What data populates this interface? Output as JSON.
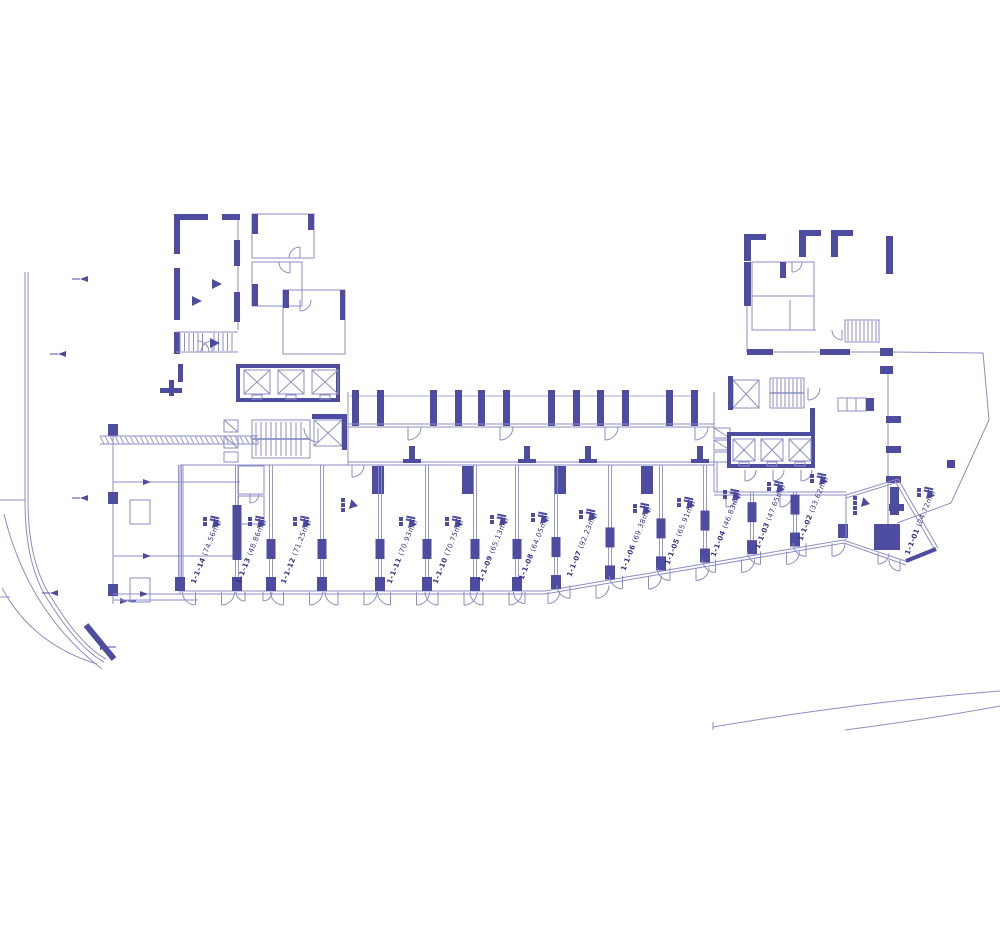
{
  "drawing": {
    "kind": "architectural-floor-plan",
    "palette": {
      "wall": "#4d4ca0",
      "line": "#8c8ec5",
      "text": "#33338c",
      "background": "#ffffff"
    }
  },
  "units": [
    {
      "id": "1-1-14",
      "area_label": "(74.56m²)"
    },
    {
      "id": "1-1-13",
      "area_label": "(48.86m²)"
    },
    {
      "id": "1-1-12",
      "area_label": "(71.25m²)"
    },
    {
      "id": "1-1-11",
      "area_label": "(70.93m²)"
    },
    {
      "id": "1-1-10",
      "area_label": "(70.75m²)"
    },
    {
      "id": "1-1-09",
      "area_label": "(65.13m²)"
    },
    {
      "id": "1-1-08",
      "area_label": "(64.05m²)"
    },
    {
      "id": "1-1-07",
      "area_label": "(92.23m²)"
    },
    {
      "id": "1-1-06",
      "area_label": "(69.38m²)"
    },
    {
      "id": "1-1-05",
      "area_label": "(65.91m²)"
    },
    {
      "id": "1-1-04",
      "area_label": "(46.83m²)"
    },
    {
      "id": "1-1-03",
      "area_label": "(47.65m²)"
    },
    {
      "id": "1-1-02",
      "area_label": "(33.62m²)"
    },
    {
      "id": "1-1-01",
      "area_label": "(24.72m²)"
    }
  ],
  "icons": [
    "elevator-shaft-icon",
    "stair-icon",
    "door-arc-icon",
    "level-marker-icon",
    "unit-tag-icon",
    "spot-level-marker-icon",
    "column-icon"
  ]
}
